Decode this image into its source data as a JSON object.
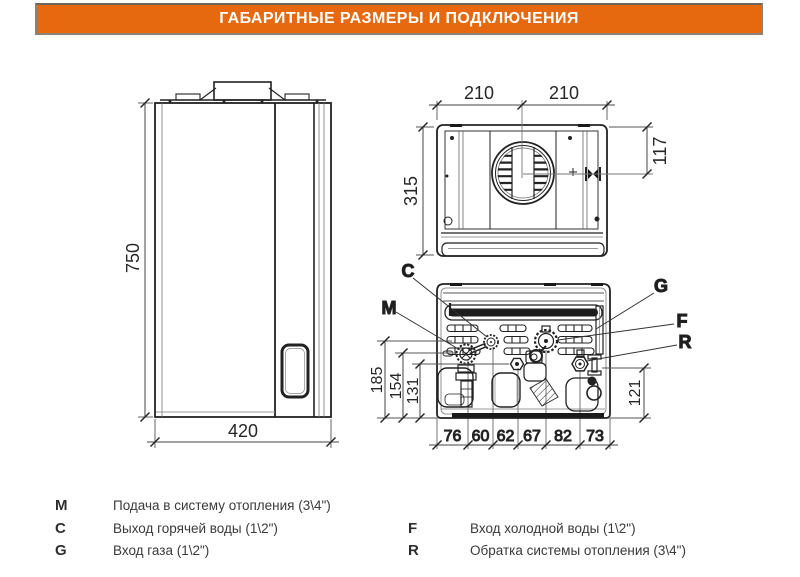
{
  "header": {
    "title": "ГАБАРИТНЫЕ РАЗМЕРЫ И ПОДКЛЮЧЕНИЯ"
  },
  "colors": {
    "accent_orange": "#e7690f",
    "line_dark": "#1c1c1c",
    "dim_gray": "#555555"
  },
  "front_view": {
    "height_mm": "750",
    "width_mm": "420"
  },
  "top_view": {
    "width_left_mm": "210",
    "width_right_mm": "210",
    "depth_mm": "315",
    "flue_offset_mm": "117"
  },
  "bottom_view": {
    "connections": {
      "M": "M",
      "C": "C",
      "G": "G",
      "F": "F",
      "R": "R"
    },
    "heights_mm": {
      "c": "185",
      "m": "154",
      "drain": "131",
      "r": "121"
    },
    "spacing_mm": [
      "76",
      "60",
      "62",
      "67",
      "82",
      "73"
    ]
  },
  "legend": {
    "left": [
      {
        "key": "M",
        "desc": "Подача в систему отопления (3\\4\")"
      },
      {
        "key": "C",
        "desc": "Выход горячей воды (1\\2\")"
      },
      {
        "key": "G",
        "desc": "Вход газа (1\\2\")"
      }
    ],
    "right": [
      {
        "key": "F",
        "desc": "Вход холодной воды (1\\2\")"
      },
      {
        "key": "R",
        "desc": "Обратка системы отопления (3\\4\")"
      }
    ]
  }
}
